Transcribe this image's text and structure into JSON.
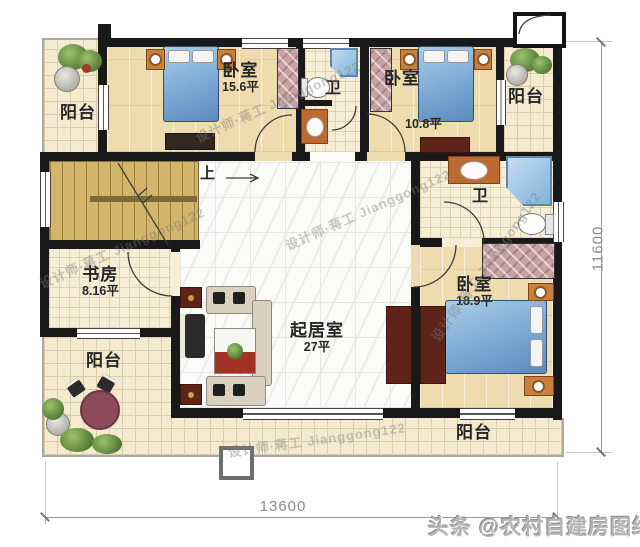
{
  "rooms": {
    "balcony_top_left": {
      "label": "阳台"
    },
    "bedroom_top_left": {
      "label": "卧室",
      "area": "15.6平"
    },
    "bathroom_top": {
      "label": "卫"
    },
    "bedroom_top_right": {
      "label": "卧室",
      "area": "10.8平"
    },
    "balcony_top_right": {
      "label": "阳台"
    },
    "bathroom_right": {
      "label": "卫"
    },
    "study": {
      "label": "书房",
      "area": "8.16平"
    },
    "living_room": {
      "label": "起居室",
      "area": "27平"
    },
    "bedroom_right": {
      "label": "卧室",
      "area": "18.9平"
    },
    "balcony_bottom_left": {
      "label": "阳台"
    },
    "balcony_bottom": {
      "label": "阳台"
    }
  },
  "stairs": {
    "direction_label": "上"
  },
  "dimensions": {
    "bottom_width": "13600",
    "right_height": "11600"
  },
  "watermarks": {
    "designer": "设计师·蒋工 Jianggong122",
    "brand": "头条 @农村自建房图纸"
  },
  "colors": {
    "wall": "#191919",
    "wood_floor": "#eedcae",
    "tile_floor": "#f4ead0",
    "marble_floor": "#fbfbf9",
    "stair": "#d2b46a",
    "bed_blue": "#7aa8d4",
    "furniture_maroon": "#5e241a",
    "wardrobe_pink": "#c7a2a4",
    "shower_blue": "#a9cbe8",
    "vanity_orange": "#bd6a32",
    "dimension_text": "#8a8a8a",
    "watermark_gray": "#b5b5b5"
  }
}
